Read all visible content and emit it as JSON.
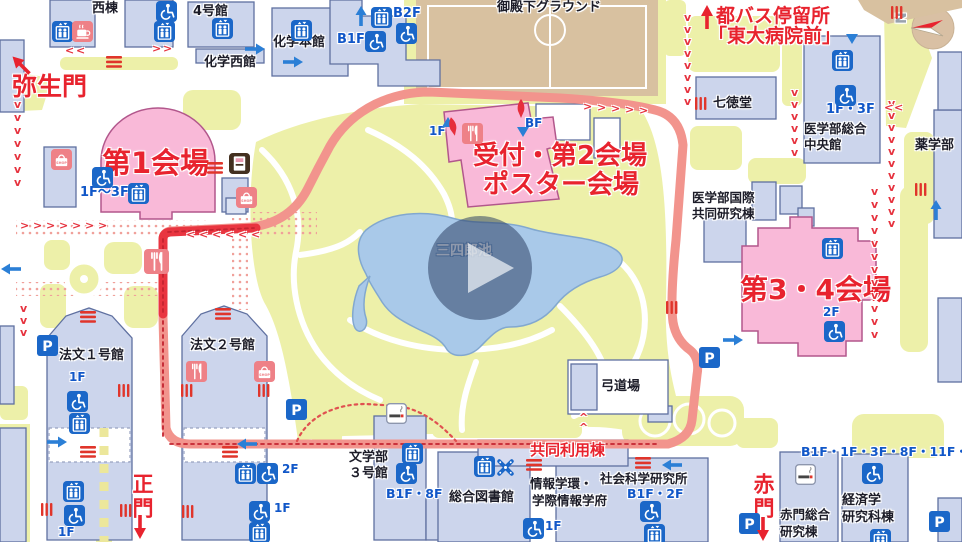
{
  "map": {
    "icon_texts": {
      "shop": "SHOP",
      "parking": "P"
    },
    "labels": [
      {
        "n": "yayoi-gate-label",
        "t": "弥生門",
        "x": 12,
        "y": 74,
        "c": "gate",
        "s": 25
      },
      {
        "n": "venue1-label",
        "t": "第1会場",
        "x": 102,
        "y": 149,
        "c": "venue",
        "s": 29
      },
      {
        "n": "reception-venue2-label",
        "t": "受付・第2会場",
        "x": 473,
        "y": 143,
        "c": "venue",
        "s": 26
      },
      {
        "n": "poster-venue-label",
        "t": "ポスター会場",
        "x": 483,
        "y": 172,
        "c": "venue",
        "s": 26
      },
      {
        "n": "venue3-4-label",
        "t": "第3・4会場",
        "x": 740,
        "y": 276,
        "c": "venue",
        "s": 28
      },
      {
        "n": "kyodo-riyoto-label",
        "t": "共同利用棟",
        "x": 530,
        "y": 443,
        "c": "redsm",
        "s": 15
      },
      {
        "n": "main-gate-label",
        "t": "正門",
        "x": 131,
        "y": 473,
        "c": "gate",
        "s": 21,
        "v": true
      },
      {
        "n": "aka-gate-label",
        "t": "赤門",
        "x": 752,
        "y": 473,
        "c": "gate",
        "s": 21,
        "v": true
      },
      {
        "n": "bus-stop-line1",
        "t": "都バス停留所",
        "x": 716,
        "y": 7,
        "c": "redmd",
        "s": 19
      },
      {
        "n": "bus-stop-line2",
        "t": "「東大病院前」",
        "x": 708,
        "y": 27,
        "c": "redmd",
        "s": 19
      },
      {
        "n": "west-bldg-label",
        "t": "西棟",
        "x": 92,
        "y": 2,
        "c": "black",
        "s": 13
      },
      {
        "n": "bldg4-label",
        "t": "4号館",
        "x": 193,
        "y": 5,
        "c": "black",
        "s": 13
      },
      {
        "n": "chem-main-label",
        "t": "化学本館",
        "x": 273,
        "y": 36,
        "c": "black",
        "s": 13
      },
      {
        "n": "chem-west-label",
        "t": "化学西館",
        "x": 204,
        "y": 56,
        "c": "black",
        "s": 13
      },
      {
        "n": "ground-label",
        "t": "御殿下グラウンド",
        "x": 497,
        "y": 1,
        "c": "black",
        "s": 13
      },
      {
        "n": "shichitokudo-label",
        "t": "七徳堂",
        "x": 713,
        "y": 97,
        "c": "black",
        "s": 13
      },
      {
        "n": "med-central-label1",
        "t": "医学部総合",
        "x": 804,
        "y": 123,
        "c": "black",
        "s": 12.5
      },
      {
        "n": "med-central-label2",
        "t": "中央館",
        "x": 804,
        "y": 139,
        "c": "black",
        "s": 12.5
      },
      {
        "n": "pharmacy-label",
        "t": "薬学部",
        "x": 915,
        "y": 139,
        "c": "black",
        "s": 13
      },
      {
        "n": "med-intl-label1",
        "t": "医学部国際",
        "x": 692,
        "y": 192,
        "c": "black",
        "s": 12.5
      },
      {
        "n": "med-intl-label2",
        "t": "共同研究棟",
        "x": 692,
        "y": 208,
        "c": "black",
        "s": 12.5
      },
      {
        "n": "pond-label",
        "t": "三四郎池",
        "x": 436,
        "y": 244,
        "c": "white",
        "s": 14
      },
      {
        "n": "hobun1-label",
        "t": "法文１号館",
        "x": 59,
        "y": 349,
        "c": "black",
        "s": 13
      },
      {
        "n": "hobun2-label",
        "t": "法文２号館",
        "x": 190,
        "y": 339,
        "c": "black",
        "s": 13
      },
      {
        "n": "bungakubu-label1",
        "t": "文学部",
        "x": 349,
        "y": 451,
        "c": "black",
        "s": 13
      },
      {
        "n": "bungakubu-label2",
        "t": "３号館",
        "x": 349,
        "y": 467,
        "c": "black",
        "s": 13
      },
      {
        "n": "library-label",
        "t": "総合図書館",
        "x": 449,
        "y": 491,
        "c": "black",
        "s": 13
      },
      {
        "n": "joho-label1",
        "t": "情報学環・",
        "x": 530,
        "y": 478,
        "c": "black",
        "s": 12.5
      },
      {
        "n": "joho-label2",
        "t": "学際情報学府",
        "x": 532,
        "y": 495,
        "c": "black",
        "s": 12.5
      },
      {
        "n": "shaken-label",
        "t": "社会科学研究所",
        "x": 600,
        "y": 473,
        "c": "black",
        "s": 12.5
      },
      {
        "n": "kyudo-label",
        "t": "弓道場",
        "x": 601,
        "y": 380,
        "c": "black",
        "s": 13
      },
      {
        "n": "akamon-bldg-label1",
        "t": "赤門総合",
        "x": 780,
        "y": 509,
        "c": "black",
        "s": 12.5
      },
      {
        "n": "akamon-bldg-label2",
        "t": "研究棟",
        "x": 780,
        "y": 526,
        "c": "black",
        "s": 12.5
      },
      {
        "n": "econ-label1",
        "t": "経済学",
        "x": 842,
        "y": 494,
        "c": "black",
        "s": 13
      },
      {
        "n": "econ-label2",
        "t": "研究科棟",
        "x": 842,
        "y": 511,
        "c": "black",
        "s": 13
      },
      {
        "n": "floor-b2f",
        "t": "B2F",
        "x": 393,
        "y": 7,
        "c": "blue",
        "s": 13
      },
      {
        "n": "floor-b1f",
        "t": "B1F",
        "x": 337,
        "y": 33,
        "c": "blue",
        "s": 13
      },
      {
        "n": "floor-1f-3f-med",
        "t": "1F・3F",
        "x": 826,
        "y": 103,
        "c": "blue",
        "s": 13
      },
      {
        "n": "floor-1f-3f-venue1",
        "t": "1F〜3F",
        "x": 80,
        "y": 186,
        "c": "blue",
        "s": 13
      },
      {
        "n": "floor-1f-reception",
        "t": "1F",
        "x": 429,
        "y": 125,
        "c": "blue",
        "s": 12
      },
      {
        "n": "floor-bf-reception",
        "t": "BF",
        "x": 525,
        "y": 117,
        "c": "blue",
        "s": 12
      },
      {
        "n": "floor-2f-venue34",
        "t": "2F",
        "x": 823,
        "y": 306,
        "c": "blue",
        "s": 12
      },
      {
        "n": "floor-1f-hobun1",
        "t": "1F",
        "x": 69,
        "y": 371,
        "c": "blue",
        "s": 12
      },
      {
        "n": "floor-2f-hobun2",
        "t": "2F",
        "x": 282,
        "y": 463,
        "c": "blue",
        "s": 12
      },
      {
        "n": "floor-1f-hobun2",
        "t": "1F",
        "x": 274,
        "y": 502,
        "c": "blue",
        "s": 12
      },
      {
        "n": "floor-b1f-8f",
        "t": "B1F・8F",
        "x": 386,
        "y": 488,
        "c": "blue",
        "s": 12.5
      },
      {
        "n": "floor-1f-library",
        "t": "1F",
        "x": 545,
        "y": 520,
        "c": "blue",
        "s": 12
      },
      {
        "n": "floor-b1f-2f",
        "t": "B1F・2F",
        "x": 627,
        "y": 488,
        "c": "blue",
        "s": 12.5
      },
      {
        "n": "floor-econ-list",
        "t": "B1F・1F・3F・8F・11F・14F",
        "x": 801,
        "y": 446,
        "c": "blue",
        "s": 12.5
      },
      {
        "n": "floor-1f-hobun1-low",
        "t": "1F",
        "x": 58,
        "y": 526,
        "c": "blue",
        "s": 12
      },
      {
        "n": "compass-n-label",
        "t": "N",
        "x": 896,
        "y": 11,
        "c": "compass",
        "s": 14,
        "r": -90
      }
    ],
    "icons": [
      {
        "t": "elevator",
        "x": 52,
        "y": 21
      },
      {
        "t": "elevator",
        "x": 154,
        "y": 21
      },
      {
        "t": "elevator",
        "x": 212,
        "y": 18
      },
      {
        "t": "elevator",
        "x": 291,
        "y": 20
      },
      {
        "t": "elevator",
        "x": 371,
        "y": 7
      },
      {
        "t": "elevator",
        "x": 832,
        "y": 50
      },
      {
        "t": "elevator",
        "x": 822,
        "y": 238
      },
      {
        "t": "elevator",
        "x": 128,
        "y": 183
      },
      {
        "t": "elevator",
        "x": 69,
        "y": 413
      },
      {
        "t": "elevator",
        "x": 63,
        "y": 481
      },
      {
        "t": "elevator",
        "x": 402,
        "y": 443
      },
      {
        "t": "elevator",
        "x": 474,
        "y": 456
      },
      {
        "t": "elevator",
        "x": 644,
        "y": 524
      },
      {
        "t": "elevator",
        "x": 870,
        "y": 529
      },
      {
        "t": "elevator",
        "x": 235,
        "y": 463
      },
      {
        "t": "elevator",
        "x": 249,
        "y": 522
      },
      {
        "t": "wheelchair",
        "x": 156,
        "y": 1
      },
      {
        "t": "wheelchair",
        "x": 396,
        "y": 23
      },
      {
        "t": "wheelchair",
        "x": 365,
        "y": 31
      },
      {
        "t": "wheelchair",
        "x": 835,
        "y": 85
      },
      {
        "t": "wheelchair",
        "x": 92,
        "y": 167
      },
      {
        "t": "wheelchair",
        "x": 824,
        "y": 321
      },
      {
        "t": "wheelchair",
        "x": 67,
        "y": 391
      },
      {
        "t": "wheelchair",
        "x": 64,
        "y": 505
      },
      {
        "t": "wheelchair",
        "x": 396,
        "y": 463
      },
      {
        "t": "wheelchair",
        "x": 523,
        "y": 518
      },
      {
        "t": "wheelchair",
        "x": 257,
        "y": 463
      },
      {
        "t": "wheelchair",
        "x": 640,
        "y": 501
      },
      {
        "t": "wheelchair",
        "x": 862,
        "y": 463
      },
      {
        "t": "wheelchair",
        "x": 249,
        "y": 501
      },
      {
        "t": "parking",
        "x": 37,
        "y": 335
      },
      {
        "t": "parking",
        "x": 286,
        "y": 399
      },
      {
        "t": "parking",
        "x": 699,
        "y": 347
      },
      {
        "t": "parking",
        "x": 739,
        "y": 513
      },
      {
        "t": "parking",
        "x": 929,
        "y": 511
      },
      {
        "t": "restaurant",
        "x": 144,
        "y": 249,
        "s": 25
      },
      {
        "t": "restaurant",
        "x": 462,
        "y": 123
      },
      {
        "t": "restaurant",
        "x": 186,
        "y": 361
      },
      {
        "t": "shop",
        "x": 51,
        "y": 149
      },
      {
        "t": "shop",
        "x": 236,
        "y": 187
      },
      {
        "t": "shop",
        "x": 254,
        "y": 361
      },
      {
        "t": "coffee",
        "x": 72,
        "y": 21
      },
      {
        "t": "atm",
        "x": 229,
        "y": 153
      },
      {
        "t": "smoking",
        "x": 386,
        "y": 403
      },
      {
        "t": "smoking",
        "x": 795,
        "y": 464
      },
      {
        "t": "asterisk",
        "x": 495,
        "y": 457
      },
      {
        "t": "redbarsh",
        "x": 207,
        "y": 162
      },
      {
        "t": "redbarsh",
        "x": 526,
        "y": 459
      },
      {
        "t": "redbarsh",
        "x": 635,
        "y": 457
      },
      {
        "t": "redbarsh",
        "x": 80,
        "y": 446
      },
      {
        "t": "redbarsh",
        "x": 222,
        "y": 446
      },
      {
        "t": "redbarsh",
        "x": 106,
        "y": 56
      },
      {
        "t": "redbarsh",
        "x": 80,
        "y": 311
      },
      {
        "t": "redbarsh",
        "x": 215,
        "y": 308
      },
      {
        "t": "redbarsv",
        "x": 695,
        "y": 97
      },
      {
        "t": "redbarsv",
        "x": 915,
        "y": 183
      },
      {
        "t": "redbarsv",
        "x": 118,
        "y": 384
      },
      {
        "t": "redbarsv",
        "x": 181,
        "y": 384
      },
      {
        "t": "redbarsv",
        "x": 258,
        "y": 384
      },
      {
        "t": "redbarsv",
        "x": 41,
        "y": 503
      },
      {
        "t": "redbarsv",
        "x": 120,
        "y": 504
      },
      {
        "t": "redbarsv",
        "x": 182,
        "y": 505
      },
      {
        "t": "redbarsv",
        "x": 891,
        "y": 6
      },
      {
        "t": "redbarsv",
        "x": 666,
        "y": 301
      }
    ],
    "arrows": [
      {
        "k": "blue",
        "x": 0,
        "y": 263,
        "r": 180
      },
      {
        "k": "blue",
        "x": 244,
        "y": 43,
        "r": 0
      },
      {
        "k": "blue",
        "x": 282,
        "y": 56,
        "r": 0
      },
      {
        "k": "blue",
        "x": 46,
        "y": 436,
        "r": 0
      },
      {
        "k": "blue",
        "x": 236,
        "y": 438,
        "r": 180
      },
      {
        "k": "blue",
        "x": 661,
        "y": 459,
        "r": 180
      },
      {
        "k": "blue",
        "x": 925,
        "y": 204,
        "r": -90
      },
      {
        "k": "blue",
        "x": 722,
        "y": 334,
        "r": 0
      },
      {
        "k": "blue",
        "x": 350,
        "y": 10,
        "r": -90
      },
      {
        "k": "tri",
        "x": 517,
        "y": 127,
        "r": 0
      },
      {
        "k": "tri",
        "x": 846,
        "y": 34,
        "r": 0
      },
      {
        "k": "tri",
        "x": 442,
        "y": 117,
        "r": 180
      },
      {
        "k": "gate",
        "x": 133,
        "y": 514,
        "r": 0
      },
      {
        "k": "gate",
        "x": 756,
        "y": 516,
        "r": 0
      },
      {
        "k": "gate",
        "x": 700,
        "y": 4,
        "r": 180
      },
      {
        "k": "gate",
        "x": 14,
        "y": 52,
        "r": 135
      },
      {
        "k": "drop",
        "x": 447,
        "y": 117,
        "r": -12
      },
      {
        "k": "drop",
        "x": 515,
        "y": 99,
        "r": 0
      }
    ],
    "chains": [
      {
        "g": "v",
        "x": 14,
        "y": 99,
        "dx": 0,
        "dy": 13,
        "n": 7
      },
      {
        "g": "v",
        "x": 20,
        "y": 303,
        "dx": 0,
        "dy": 12,
        "n": 3
      },
      {
        "g": "v",
        "x": 684,
        "y": 12,
        "dx": 0,
        "dy": 12,
        "n": 8
      },
      {
        "g": "v",
        "x": 791,
        "y": 87,
        "dx": 0,
        "dy": 12,
        "n": 6
      },
      {
        "g": "v",
        "x": 888,
        "y": 98,
        "dx": 0,
        "dy": 12,
        "n": 11
      },
      {
        "g": "v",
        "x": 871,
        "y": 186,
        "dx": 0,
        "dy": 13,
        "n": 12
      },
      {
        "g": ">",
        "x": 583,
        "y": 101,
        "dx": 14,
        "dy": 1,
        "n": 5
      },
      {
        "g": ">",
        "x": 20,
        "y": 220,
        "dx": 13,
        "dy": 0,
        "n": 7
      },
      {
        "g": "<",
        "x": 186,
        "y": 229,
        "dx": 13,
        "dy": 0,
        "n": 6
      },
      {
        "g": "<",
        "x": 65,
        "y": 45,
        "dx": 11,
        "dy": 0,
        "n": 2
      },
      {
        "g": ">",
        "x": 152,
        "y": 43,
        "dx": 11,
        "dy": 0,
        "n": 2
      },
      {
        "g": "^",
        "x": 579,
        "y": 412,
        "dx": 0,
        "dy": 10,
        "n": 2
      },
      {
        "g": "<",
        "x": 884,
        "y": 102,
        "dx": 10,
        "dy": 0,
        "n": 2
      }
    ]
  }
}
